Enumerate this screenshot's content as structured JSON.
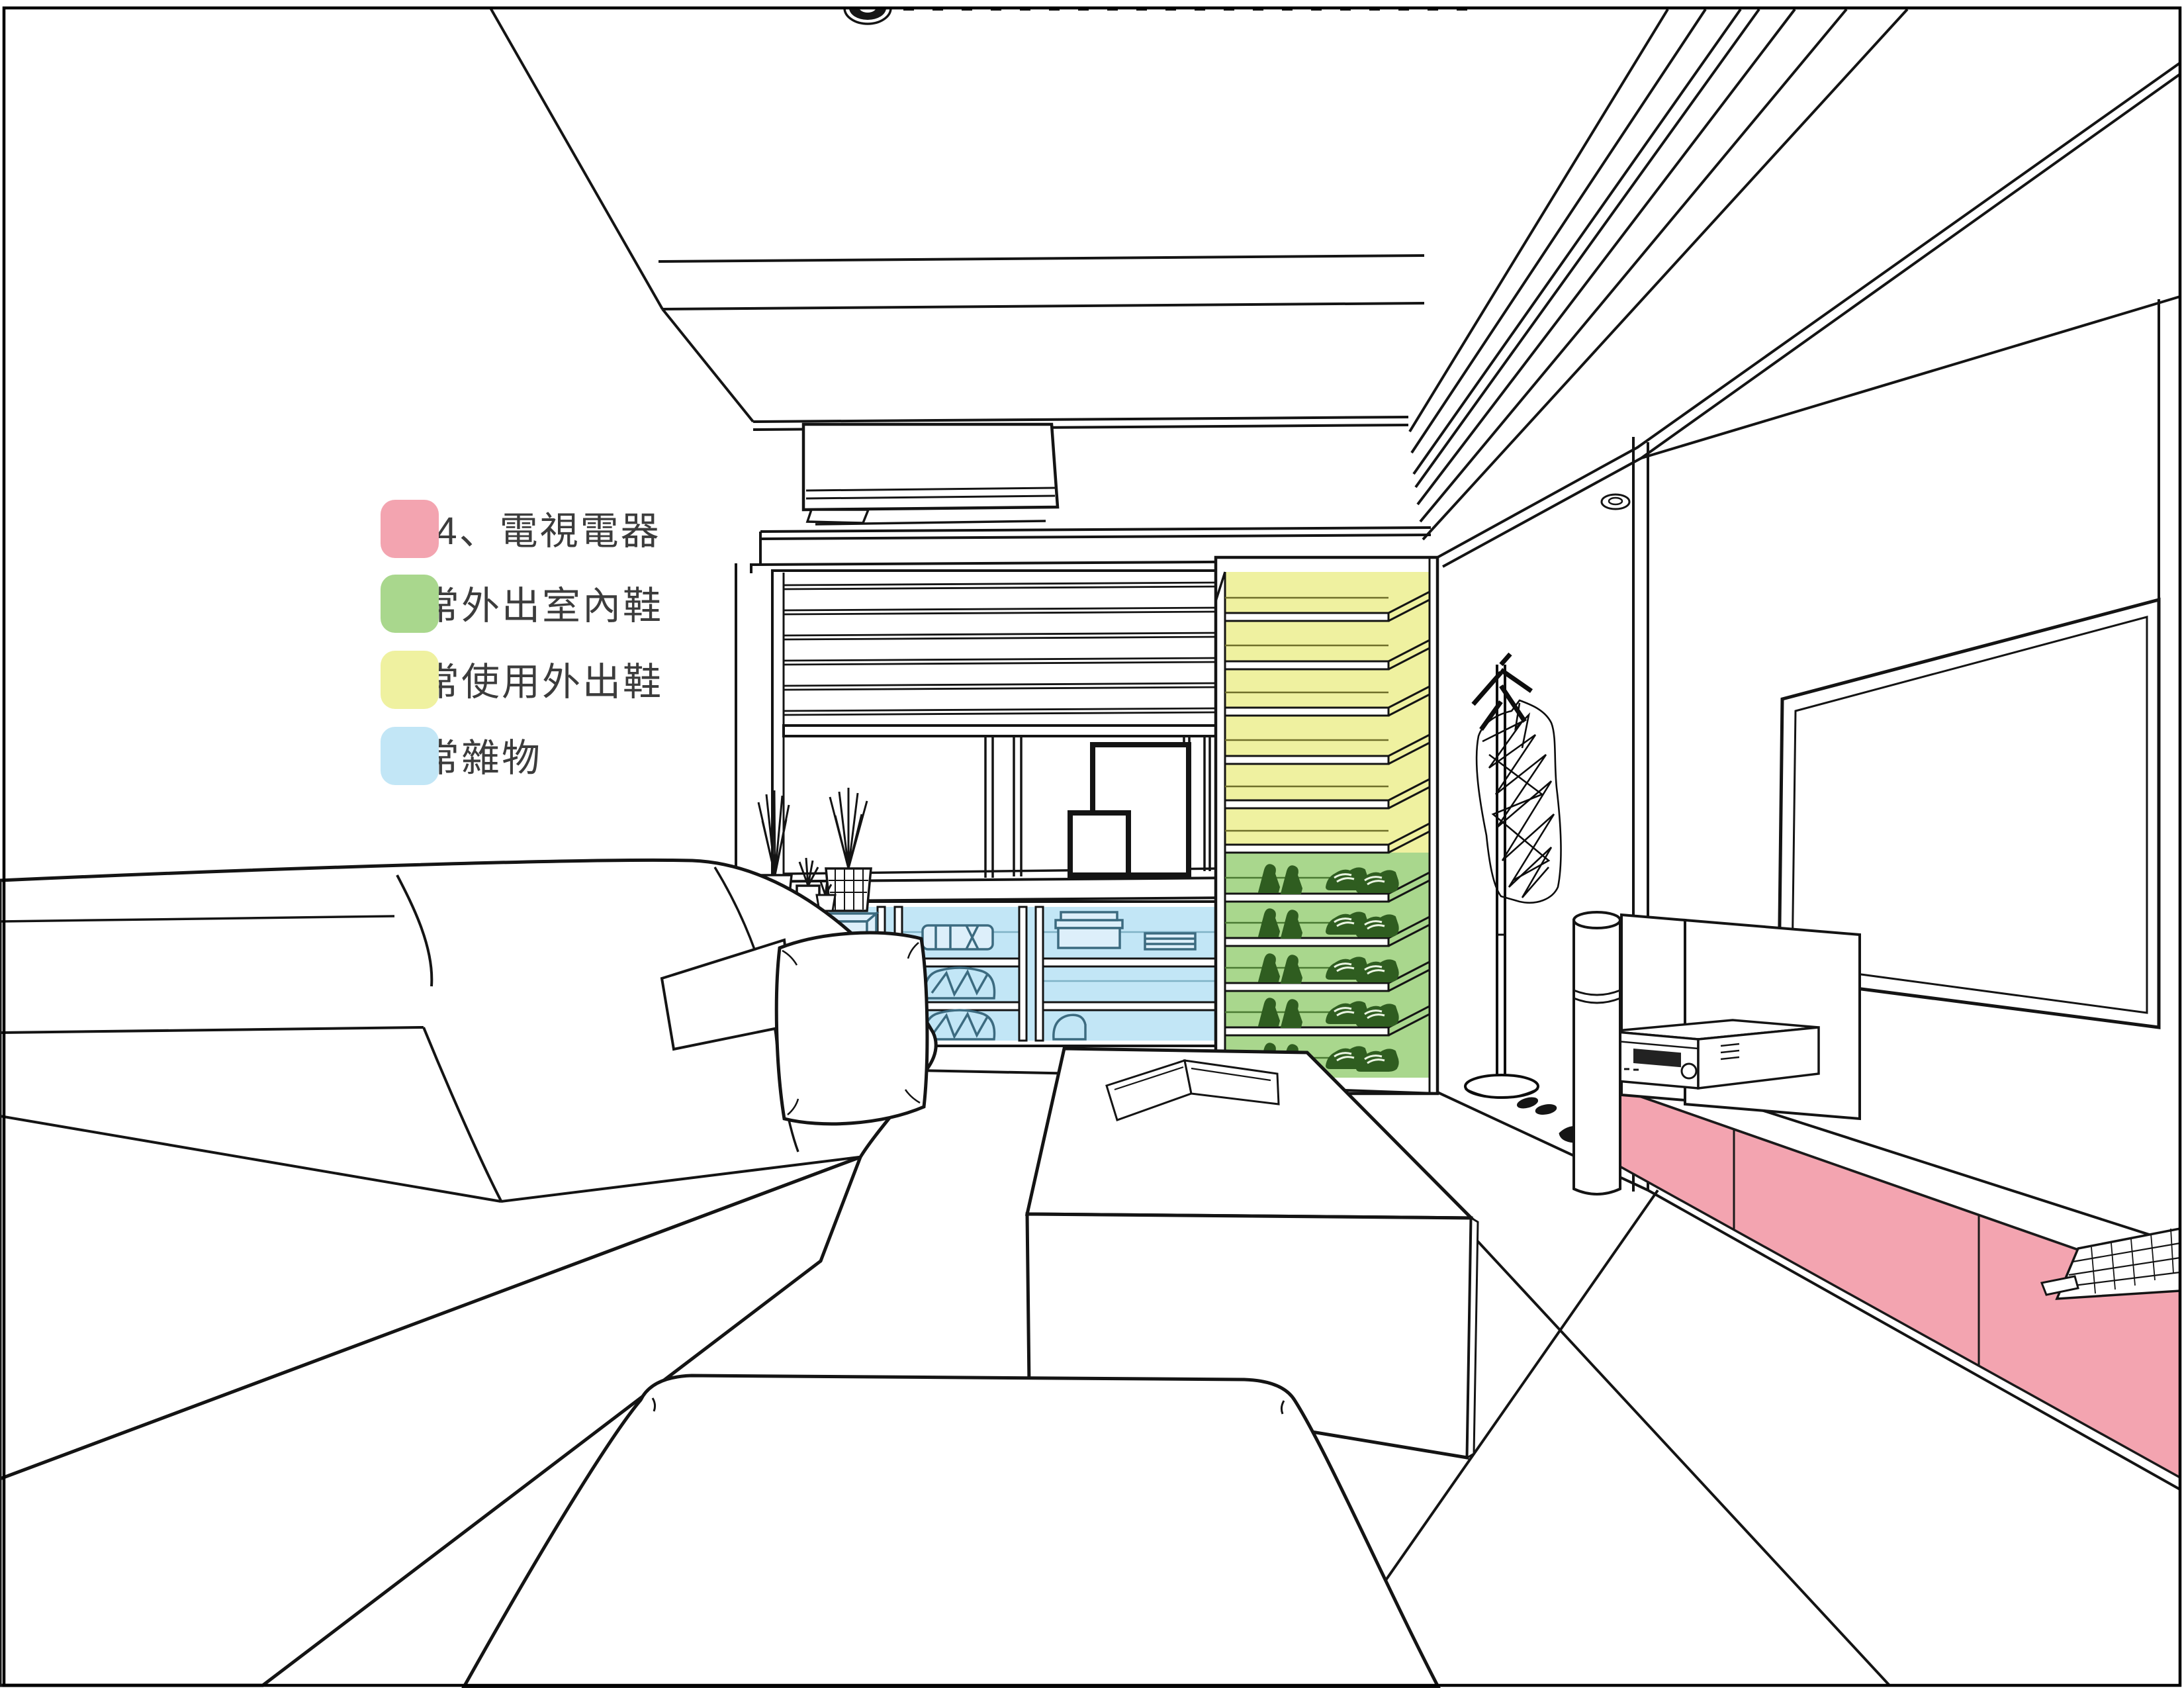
{
  "legend": {
    "items": [
      {
        "id": "ps4-tv-appliances",
        "label": "PS4、電視電器",
        "color": "#F3A4B0"
      },
      {
        "id": "daily-shoes",
        "label": "日常外出室內鞋",
        "color": "#A9D78D"
      },
      {
        "id": "rarely-used-shoes",
        "label": "不常使用外出鞋",
        "color": "#EFF1A0"
      },
      {
        "id": "daily-sundries",
        "label": "日常雜物",
        "color": "#C2E6F6"
      }
    ]
  },
  "colors": {
    "outline": "#141414",
    "label_text": "#3C3C3C",
    "background": "#FFFFFF",
    "shoe_line": "#2F5D20",
    "blue_item_line": "#3C6B80",
    "yellow_shelf_line": "#70702A",
    "green_shelf_line": "#4A7A33"
  },
  "scene": {
    "highlighted_zones": [
      {
        "zone": "tv-console-front",
        "legend_label": "PS4、電視電器"
      },
      {
        "zone": "shoe-cabinet-lower-shelves",
        "legend_label": "日常外出室內鞋"
      },
      {
        "zone": "shoe-cabinet-upper-shelves",
        "legend_label": "不常使用外出鞋"
      },
      {
        "zone": "window-cabinet-shelves",
        "legend_label": "日常雜物"
      }
    ]
  }
}
